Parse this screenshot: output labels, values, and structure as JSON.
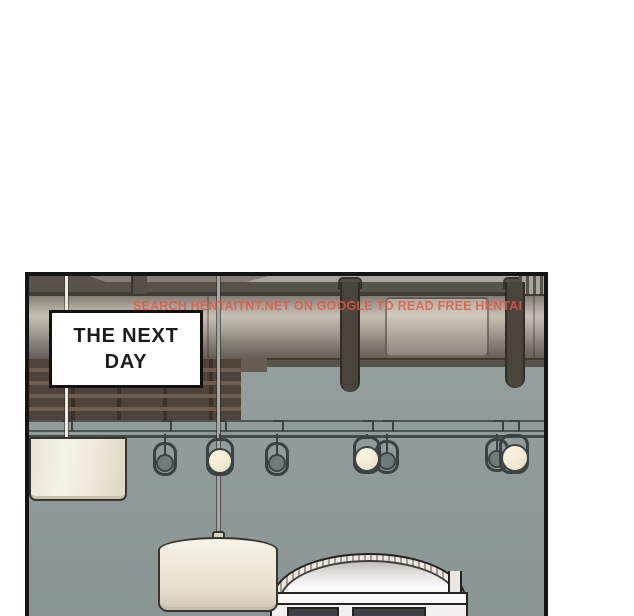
{
  "panel": {
    "caption": {
      "line1": "THE NEXT",
      "line2": "DAY"
    },
    "watermark": {
      "text": "SEARCH HENTAITNT.NET ON GOOGLE TO READ FREE HENTAI",
      "color": "#e25a43"
    },
    "colors": {
      "panel_border": "#151515",
      "wall": "#919c9b",
      "pipe_highlight": "#c6c0b5",
      "ceiling_beam": "#59524b",
      "scaffold": "#4e423a",
      "lamp_shade": "#efe9dc",
      "lit_bulb": "#f3ecd6",
      "unlit_bulb": "#717b7c",
      "headboard": "#fbfbfa"
    }
  }
}
